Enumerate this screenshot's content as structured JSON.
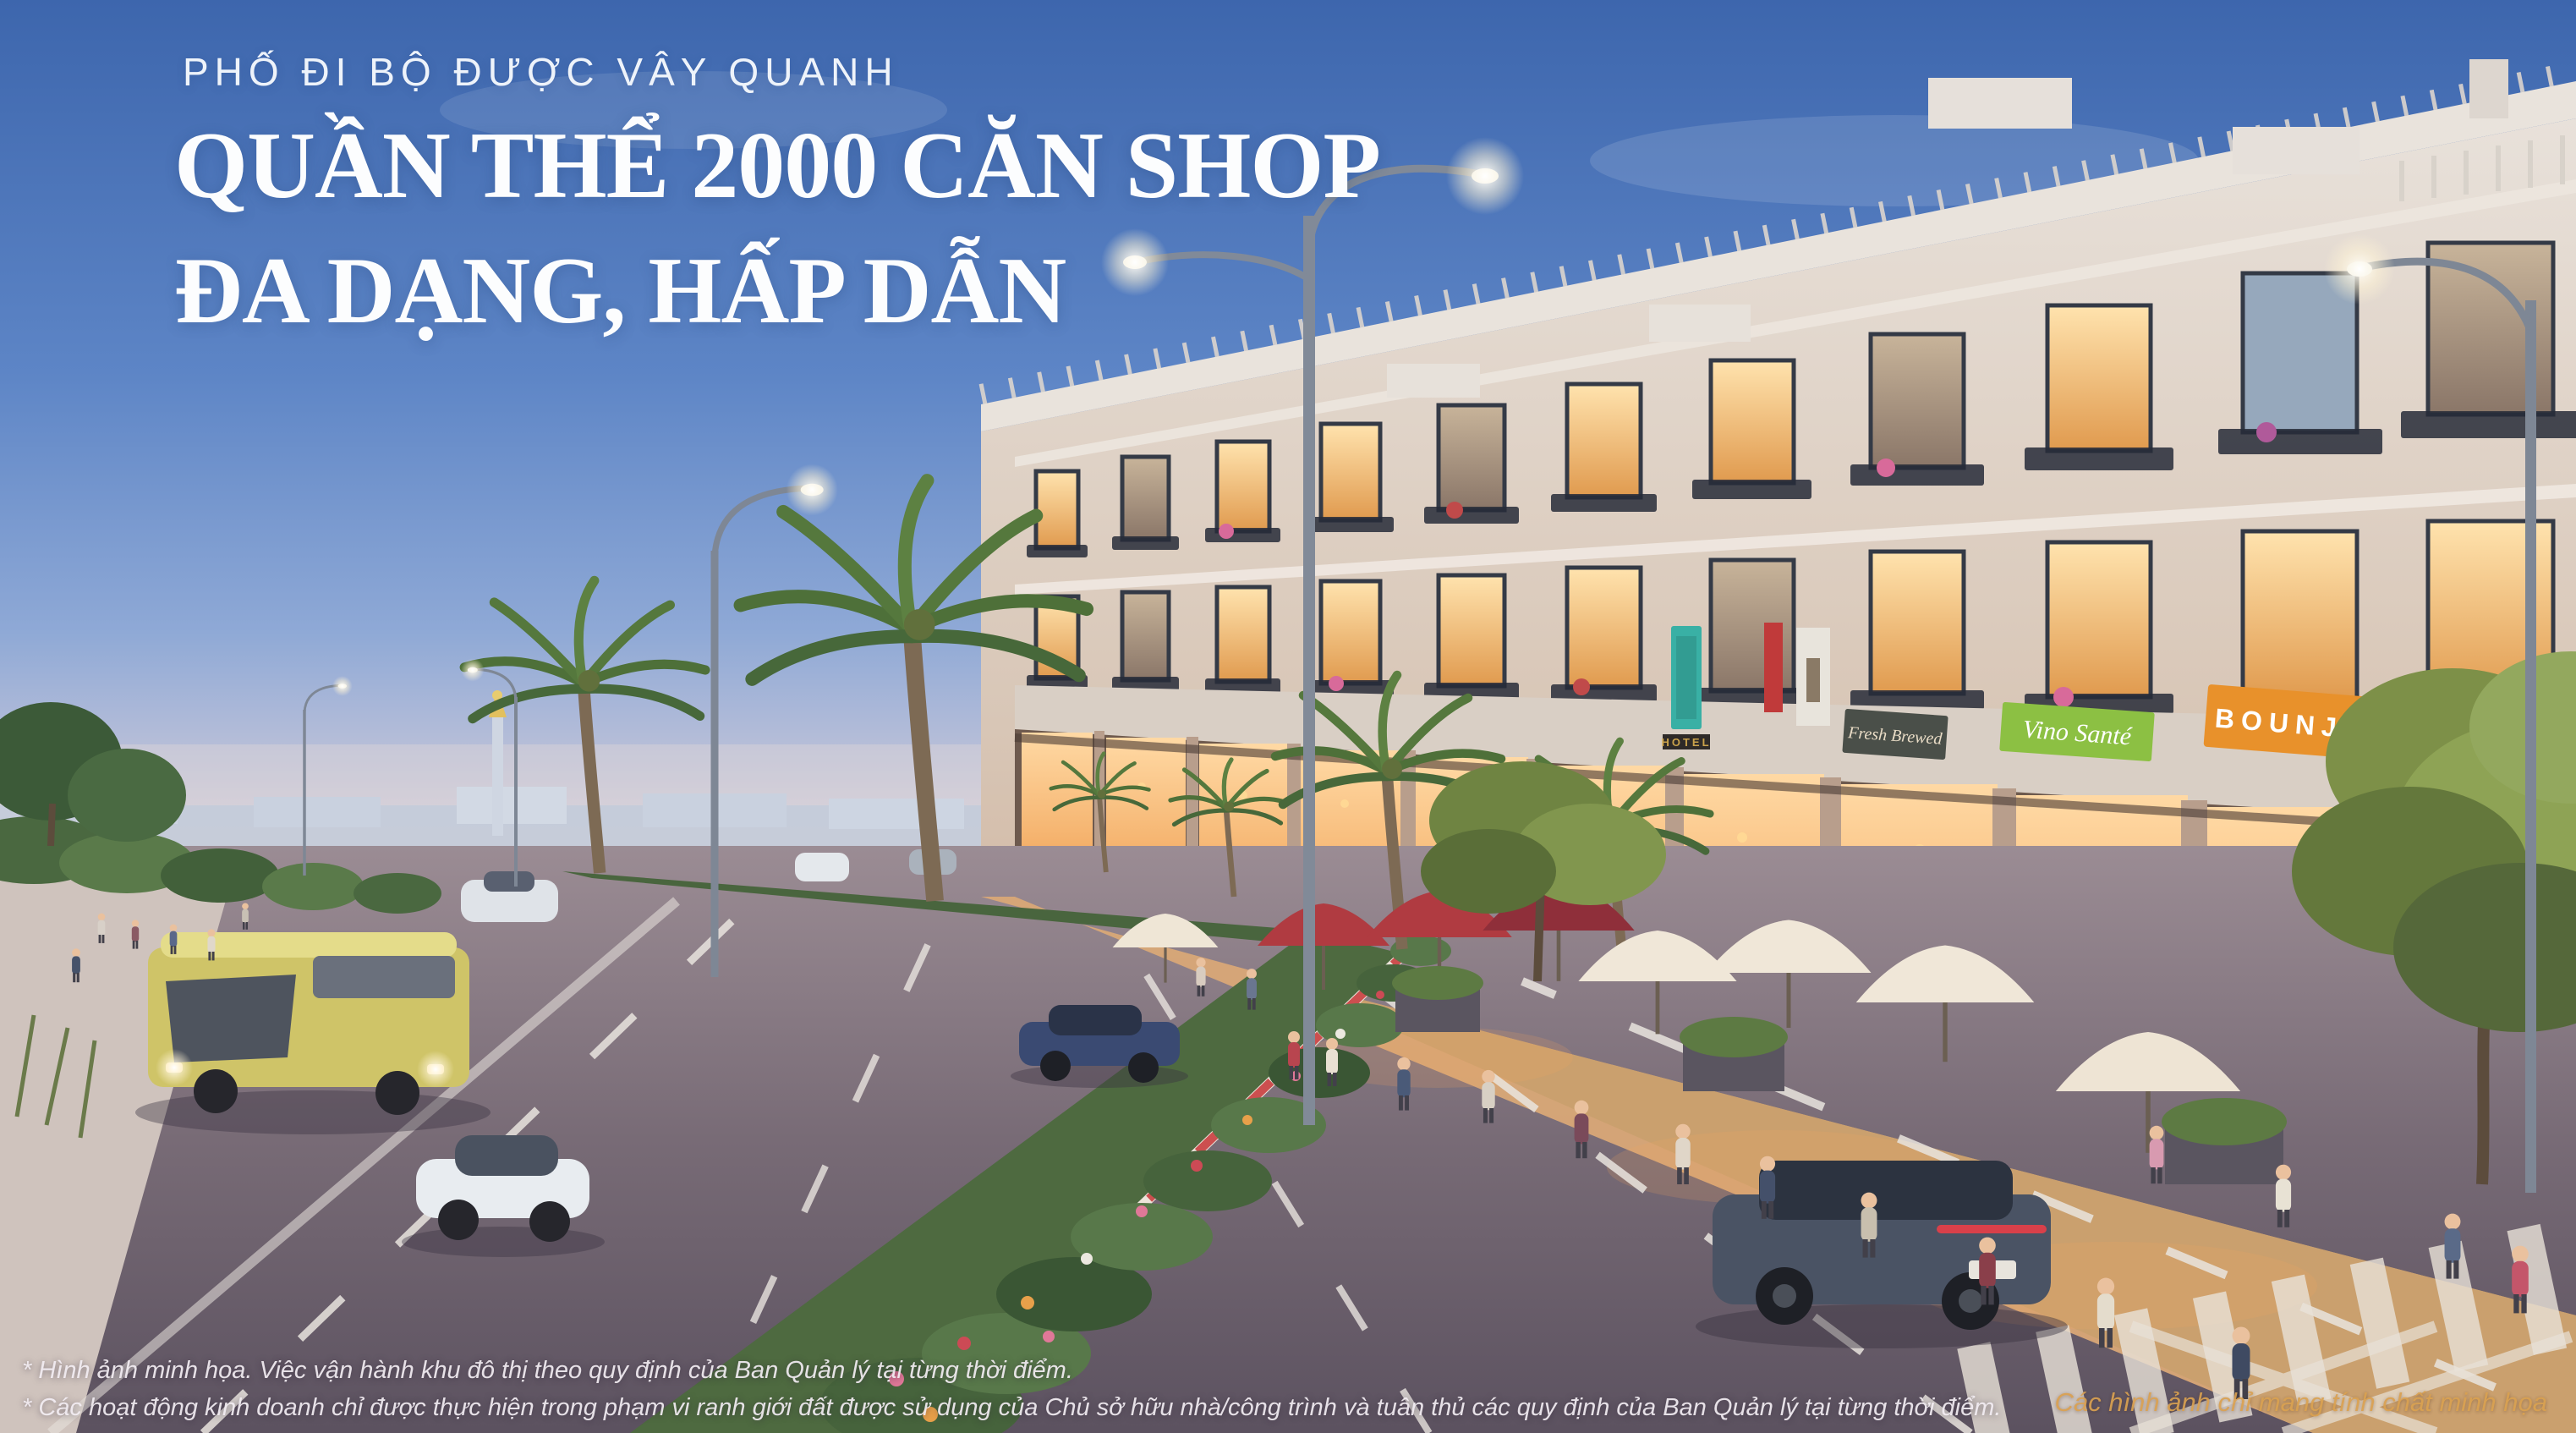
{
  "header": {
    "eyebrow": "PHỐ ĐI BỘ ĐƯỢC VÂY QUANH",
    "title_line1": "QUẦN THỂ 2000 CĂN SHOP",
    "title_line2": "ĐA DẠNG, HẤP DẪN",
    "text_color": "#fcfdfe"
  },
  "disclaimers": {
    "line1": "* Hình ảnh minh họa. Việc vận hành khu đô thị theo quy định của Ban Quản lý tại từng thời điểm.",
    "line2": "* Các hoạt động kinh doanh chỉ được thực hiện trong phạm vi ranh giới đất được sử dụng của Chủ sở hữu nhà/công trình và tuân thủ các quy định của Ban Quản lý tại từng thời điểm."
  },
  "watermark": {
    "text": "Các hình ảnh chỉ mang tính chất minh họa",
    "color": "#d9a050"
  },
  "scene": {
    "shop_signs": [
      {
        "id": "fresh-brewed",
        "label": "Fresh Brewed",
        "bg": "#4a4f49",
        "text_color": "#e9dcc6"
      },
      {
        "id": "vino-sante",
        "label": "Vino Santé",
        "bg": "#8cc043",
        "text_color": "#ffffff"
      },
      {
        "id": "bounjou",
        "label": "BOUNJOU",
        "bg": "#e8912b",
        "text_color": "#ffffff"
      },
      {
        "id": "apotek",
        "label": "apotek",
        "bg": "#f5efe6",
        "text_color": "#3b3b3b"
      },
      {
        "id": "hotel",
        "label": "HOTEL",
        "bg": "#39b0a5",
        "text_color": "#caa24b"
      }
    ],
    "palette": {
      "sky_top": "#3d66ad",
      "sky_horizon": "#e2d5d2",
      "facade": "#e3dcd6",
      "asphalt": "#5f5663",
      "arcade_glow": "#f3a95c"
    }
  }
}
